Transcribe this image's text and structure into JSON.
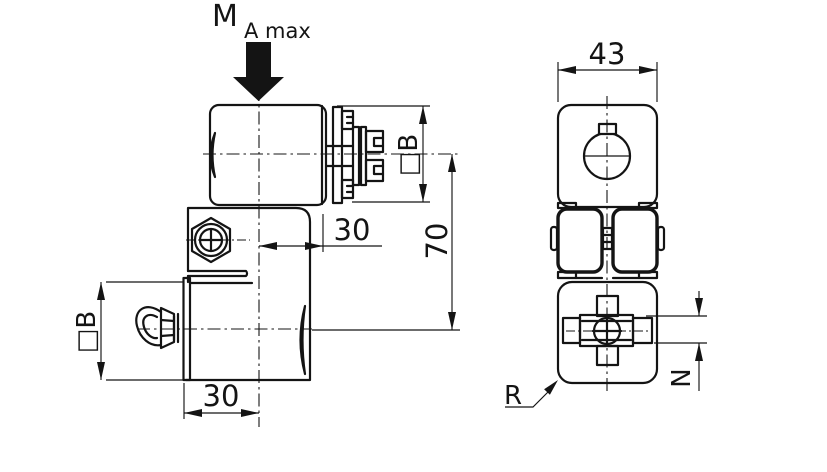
{
  "page": {
    "background": "#ffffff",
    "line_color": "#141414",
    "description": "2D technical drawing of a 90-degree cross tube clamp connector, front view and end view"
  },
  "annotations": {
    "moment_label": "M",
    "moment_subscript": "A max",
    "radius_label": "R"
  },
  "dimensions": {
    "top_width": "43",
    "center_distance": "70",
    "mid_offset": "30",
    "bottom_offset": "30",
    "upper_square": "□B",
    "lower_square": "□B",
    "nut_height": "N"
  }
}
